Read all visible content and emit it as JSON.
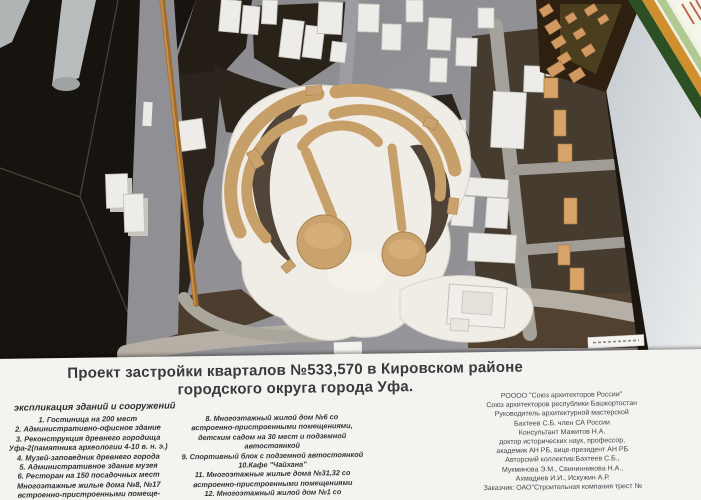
{
  "scene": {
    "description_names": [
      "city-model",
      "ancient-site-model",
      "certificate-frame",
      "pointer-stick",
      "mini-fortress-model"
    ],
    "colors": {
      "panel_bg": "#f3f3f0",
      "base_gray": "#919195",
      "block_dark": "#2b241c",
      "building_white": "#edece8",
      "existing_building_tan": "#d7a368",
      "site_tan": "#c79f69",
      "wall": "#d9dde0",
      "certificate_frame_green": "#2c4f24",
      "certificate_frame_gold": "#d08f2e",
      "pointer_wood": "#a06c2e"
    }
  },
  "panel": {
    "title_line1": "Проект застройки кварталов №533,570 в Кировском районе",
    "title_line2": "городского округа города Уфа.",
    "legend_header": "экспликация зданий и сооружений",
    "column1": [
      "1. Гостиница на 200 мест",
      "2. Административно-офисное здание",
      "3. Реконструкция древнего городища",
      "Уфа-2(памятника археологии 4-10 в. н. э.)",
      "4. Музей-заповедник древнего города",
      "5. Административное здание музея",
      "6. Ресторан на 150 посадочных мест",
      "Многоэтажные жилые дома №8, №17",
      "встроенно-пристроенными помеще-",
      "ниями и подземной автостоянкой"
    ],
    "column2": [
      "8. Многоэтажный жилой дом №6 со",
      "встроенно-пристроенными помещениями,",
      "детским садом на 30 мест и подземной",
      "автостоянкой",
      "9. Спортивный блок с подземной автостоянкой",
      "10.Кафе \"Чайхана\"",
      "11. Многоэтажные жилые дома №31,32 со",
      "встроенно-пристроенными помещениями",
      "12. Многоэтажный жилой дом №1 со",
      "встроенно-пристроенными помещениями"
    ],
    "column3": [
      "РОООО \"Союз архитекторов России\"",
      "Союз архитекторов республики Башкортостан",
      "Руководитель архитектурной мастерской",
      "Бахтеев С.Б. член СА России",
      "Консультант Мажитов Н.А.",
      "доктор исторических наук, профессор,",
      "академик АН РБ, вице-президент АН РБ",
      "Авторский коллектив:Бахтеев С.Б.,",
      "Мукминова Э.М., Свининникова Н.А.,",
      "Ахмадиев И.И., Искужин А.Р.",
      "Заказчик: ОАО\"Строительная компания трест №"
    ]
  }
}
